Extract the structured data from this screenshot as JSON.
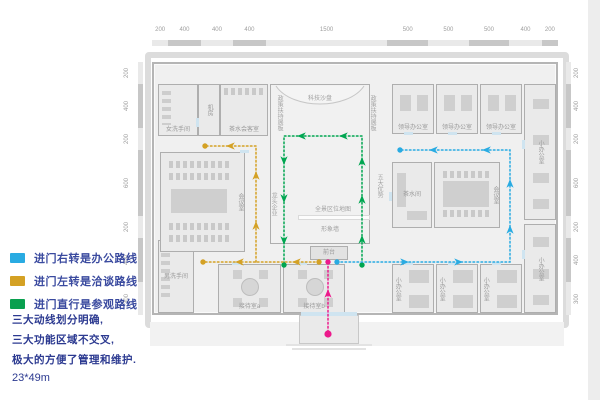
{
  "legend": {
    "items": [
      {
        "id": "office-route",
        "color": "#29abe2",
        "label": "进门右转是办公路线"
      },
      {
        "id": "negotiation-route",
        "color": "#d4a124",
        "label": "进门左转是洽谈路线"
      },
      {
        "id": "tour-route",
        "color": "#0aa04f",
        "label": "进门直行是参观路线"
      }
    ]
  },
  "notes": {
    "lines": [
      "三大动线划分明确,",
      "三大功能区域不交叉,",
      "极大的方便了管理和维护."
    ],
    "dimension": "23*49m"
  },
  "rulers": {
    "top": {
      "values": [
        200,
        400,
        400,
        400,
        1500,
        500,
        500,
        500,
        400,
        200
      ],
      "total": 5000
    },
    "left": {
      "values": [
        200,
        400,
        200,
        600,
        200,
        400,
        300
      ],
      "total": 2300
    },
    "right": {
      "values": [
        200,
        400,
        200,
        600,
        200,
        400,
        300
      ],
      "total": 2300
    }
  },
  "plan": {
    "rooms": [
      {
        "id": "women-restroom",
        "label": "女洗手间",
        "x": 158,
        "y": 84,
        "w": 40,
        "h": 52,
        "mode": "bottom",
        "shapes": [
          {
            "t": "stripes-v",
            "x": 3,
            "y": 6,
            "w": 9,
            "h": 34
          }
        ]
      },
      {
        "id": "machine-room",
        "label": "机房",
        "x": 198,
        "y": 84,
        "w": 22,
        "h": 52,
        "mode": "vcenter"
      },
      {
        "id": "tea-reception-room",
        "label": "茶水会客室",
        "x": 220,
        "y": 84,
        "w": 48,
        "h": 52,
        "mode": "bottom",
        "shapes": [
          {
            "t": "stripes-h",
            "x": 3,
            "y": 3,
            "w": 42,
            "h": 7
          }
        ]
      },
      {
        "id": "exhibition-hall",
        "label": "",
        "x": 270,
        "y": 84,
        "w": 100,
        "h": 160,
        "mode": "center",
        "fill": "#f1f1f1"
      },
      {
        "id": "leader-office-1",
        "label": "领导办公室",
        "x": 392,
        "y": 84,
        "w": 42,
        "h": 50,
        "mode": "bottom",
        "shapes": [
          {
            "t": "rect",
            "x": 7,
            "y": 10,
            "w": 11,
            "h": 16
          },
          {
            "t": "rect",
            "x": 24,
            "y": 10,
            "w": 11,
            "h": 16
          }
        ]
      },
      {
        "id": "leader-office-2",
        "label": "领导办公室",
        "x": 436,
        "y": 84,
        "w": 42,
        "h": 50,
        "mode": "bottom",
        "shapes": [
          {
            "t": "rect",
            "x": 7,
            "y": 10,
            "w": 11,
            "h": 16
          },
          {
            "t": "rect",
            "x": 24,
            "y": 10,
            "w": 11,
            "h": 16
          }
        ]
      },
      {
        "id": "leader-office-3",
        "label": "领导办公室",
        "x": 480,
        "y": 84,
        "w": 42,
        "h": 50,
        "mode": "bottom",
        "shapes": [
          {
            "t": "rect",
            "x": 7,
            "y": 10,
            "w": 11,
            "h": 16
          },
          {
            "t": "rect",
            "x": 24,
            "y": 10,
            "w": 11,
            "h": 16
          }
        ]
      },
      {
        "id": "small-office-strip-top",
        "label": "小办公室",
        "x": 524,
        "y": 84,
        "w": 32,
        "h": 136,
        "mode": "vcenter",
        "shapes": [
          {
            "t": "rect",
            "x": 8,
            "y": 14,
            "w": 16,
            "h": 10
          },
          {
            "t": "rect",
            "x": 8,
            "y": 50,
            "w": 16,
            "h": 10
          },
          {
            "t": "rect",
            "x": 8,
            "y": 88,
            "w": 16,
            "h": 10
          },
          {
            "t": "rect",
            "x": 8,
            "y": 114,
            "w": 16,
            "h": 10
          }
        ]
      },
      {
        "id": "tea-room-right",
        "label": "茶水间",
        "x": 392,
        "y": 162,
        "w": 40,
        "h": 66,
        "mode": "center",
        "shapes": [
          {
            "t": "rect",
            "x": 4,
            "y": 10,
            "w": 9,
            "h": 34
          },
          {
            "t": "rect",
            "x": 14,
            "y": 48,
            "w": 20,
            "h": 9
          }
        ]
      },
      {
        "id": "meeting-room-right",
        "label": "会议室",
        "x": 434,
        "y": 162,
        "w": 66,
        "h": 66,
        "mode": "vright",
        "shapes": [
          {
            "t": "stripes-h",
            "x": 8,
            "y": 8,
            "w": 46,
            "h": 7
          },
          {
            "t": "rect",
            "x": 8,
            "y": 18,
            "w": 46,
            "h": 26
          },
          {
            "t": "stripes-h",
            "x": 8,
            "y": 47,
            "w": 46,
            "h": 7
          }
        ]
      },
      {
        "id": "small-office-strip-bottom",
        "label": "小办公室",
        "x": 524,
        "y": 224,
        "w": 32,
        "h": 89,
        "mode": "vcenter",
        "shapes": [
          {
            "t": "rect",
            "x": 8,
            "y": 12,
            "w": 16,
            "h": 10
          },
          {
            "t": "rect",
            "x": 8,
            "y": 44,
            "w": 16,
            "h": 10
          },
          {
            "t": "rect",
            "x": 8,
            "y": 70,
            "w": 16,
            "h": 10
          }
        ]
      },
      {
        "id": "mens-restroom",
        "label": "男洗手间",
        "x": 158,
        "y": 240,
        "w": 36,
        "h": 73,
        "mode": "center",
        "shapes": [
          {
            "t": "stripes-v",
            "x": 2,
            "y": 12,
            "w": 9,
            "h": 48
          }
        ]
      },
      {
        "id": "reception-room-a",
        "label": "接待室a",
        "x": 218,
        "y": 264,
        "w": 63,
        "h": 49,
        "mode": "bottom",
        "shapes": [
          {
            "t": "circle",
            "x": 22,
            "y": 13,
            "w": 18,
            "h": 18
          },
          {
            "t": "rect",
            "x": 14,
            "y": 5,
            "w": 9,
            "h": 9
          },
          {
            "t": "rect",
            "x": 40,
            "y": 5,
            "w": 9,
            "h": 9
          },
          {
            "t": "rect",
            "x": 14,
            "y": 33,
            "w": 9,
            "h": 9
          },
          {
            "t": "rect",
            "x": 40,
            "y": 33,
            "w": 9,
            "h": 9
          }
        ]
      },
      {
        "id": "reception-room-b",
        "label": "接待室b",
        "x": 283,
        "y": 264,
        "w": 62,
        "h": 49,
        "mode": "bottom",
        "shapes": [
          {
            "t": "circle",
            "x": 22,
            "y": 13,
            "w": 18,
            "h": 18
          },
          {
            "t": "rect",
            "x": 14,
            "y": 5,
            "w": 9,
            "h": 9
          },
          {
            "t": "rect",
            "x": 40,
            "y": 5,
            "w": 9,
            "h": 9
          },
          {
            "t": "rect",
            "x": 14,
            "y": 33,
            "w": 9,
            "h": 9
          },
          {
            "t": "rect",
            "x": 40,
            "y": 33,
            "w": 9,
            "h": 9
          }
        ]
      },
      {
        "id": "small-office-1",
        "label": "小办公室",
        "x": 392,
        "y": 264,
        "w": 42,
        "h": 49,
        "mode": "vleft",
        "shapes": [
          {
            "t": "rect",
            "x": 16,
            "y": 5,
            "w": 20,
            "h": 13
          },
          {
            "t": "rect",
            "x": 16,
            "y": 30,
            "w": 20,
            "h": 13
          }
        ]
      },
      {
        "id": "small-office-2",
        "label": "小办公室",
        "x": 436,
        "y": 264,
        "w": 42,
        "h": 49,
        "mode": "vleft",
        "shapes": [
          {
            "t": "rect",
            "x": 16,
            "y": 5,
            "w": 20,
            "h": 13
          },
          {
            "t": "rect",
            "x": 16,
            "y": 30,
            "w": 20,
            "h": 13
          }
        ]
      },
      {
        "id": "small-office-3",
        "label": "小办公室",
        "x": 480,
        "y": 264,
        "w": 42,
        "h": 49,
        "mode": "vleft",
        "shapes": [
          {
            "t": "rect",
            "x": 16,
            "y": 5,
            "w": 20,
            "h": 13
          },
          {
            "t": "rect",
            "x": 16,
            "y": 30,
            "w": 20,
            "h": 13
          }
        ]
      },
      {
        "id": "meeting-room-left",
        "label": "会议室",
        "x": 160,
        "y": 152,
        "w": 85,
        "h": 100,
        "mode": "vright",
        "shapes": [
          {
            "t": "stripes-h",
            "x": 8,
            "y": 8,
            "w": 60,
            "h": 7
          },
          {
            "t": "stripes-h",
            "x": 8,
            "y": 20,
            "w": 60,
            "h": 7
          },
          {
            "t": "rect",
            "x": 10,
            "y": 36,
            "w": 56,
            "h": 24
          },
          {
            "t": "stripes-h",
            "x": 8,
            "y": 70,
            "w": 60,
            "h": 7
          },
          {
            "t": "stripes-h",
            "x": 8,
            "y": 82,
            "w": 60,
            "h": 7
          }
        ]
      },
      {
        "id": "front-desk",
        "label": "前台",
        "x": 310,
        "y": 246,
        "w": 38,
        "h": 14,
        "mode": "center",
        "fill": "#e2e2e2"
      }
    ],
    "texts": [
      {
        "id": "tech-sandtable-label",
        "label": "科技沙盘",
        "x": 320,
        "y": 99
      },
      {
        "id": "policy-board-left",
        "label": "政策扶持展板",
        "x": 279,
        "y": 113,
        "v": 1
      },
      {
        "id": "policy-board-right",
        "label": "政策扶持展板",
        "x": 372,
        "y": 113,
        "v": 1
      },
      {
        "id": "five-advantages-board",
        "label": "五大优势",
        "x": 379,
        "y": 186,
        "v": 1
      },
      {
        "id": "leading-enterprise-board",
        "label": "龙头企业",
        "x": 273,
        "y": 204,
        "v": 1
      },
      {
        "id": "panorama-map-wall",
        "label": "全景区位地图",
        "x": 333,
        "y": 210
      },
      {
        "id": "image-wall",
        "label": "形象墙",
        "x": 330,
        "y": 230
      }
    ],
    "doors": [
      [
        404,
        132,
        9,
        3
      ],
      [
        448,
        132,
        9,
        3
      ],
      [
        492,
        132,
        9,
        3
      ],
      [
        404,
        262,
        9,
        3
      ],
      [
        448,
        262,
        9,
        3
      ],
      [
        492,
        262,
        9,
        3
      ],
      [
        232,
        262,
        9,
        3
      ],
      [
        298,
        262,
        9,
        3
      ],
      [
        522,
        140,
        3,
        9
      ],
      [
        522,
        250,
        3,
        9
      ],
      [
        389,
        192,
        3,
        9
      ],
      [
        240,
        150,
        9,
        3
      ],
      [
        196,
        118,
        3,
        9
      ],
      [
        301,
        312,
        56,
        4
      ]
    ],
    "decor": [
      {
        "x": 298,
        "y": 215,
        "w": 72,
        "h": 5
      }
    ],
    "steps": [
      [
        286,
        344,
        86,
        2
      ],
      [
        292,
        348,
        74,
        2
      ]
    ],
    "hall_curve": "M276,86 C292,110 348,110 364,86",
    "routes": [
      {
        "id": "tour-route-green",
        "color": "#00a651",
        "lines": [
          [
            [
              362,
              264
            ],
            [
              362,
              136
            ],
            [
              284,
              136
            ],
            [
              284,
              264
            ]
          ]
        ],
        "dots": [
          [
            362,
            265
          ],
          [
            284,
            265
          ]
        ],
        "arrows": [
          [
            362,
            240,
            0
          ],
          [
            362,
            200,
            0
          ],
          [
            362,
            162,
            0
          ],
          [
            344,
            136,
            270
          ],
          [
            302,
            136,
            270
          ],
          [
            284,
            160,
            180
          ],
          [
            284,
            198,
            180
          ],
          [
            284,
            240,
            180
          ]
        ]
      },
      {
        "id": "negotiation-route-gold",
        "color": "#d4a124",
        "lines": [
          [
            [
              319,
              262
            ],
            [
              203,
              262
            ]
          ],
          [
            [
              256,
              262
            ],
            [
              256,
              146
            ],
            [
              205,
              146
            ]
          ]
        ],
        "dots": [
          [
            319,
            262
          ],
          [
            203,
            262
          ],
          [
            205,
            146
          ]
        ],
        "arrows": [
          [
            297,
            262,
            270
          ],
          [
            240,
            262,
            270
          ],
          [
            256,
            226,
            0
          ],
          [
            256,
            176,
            0
          ],
          [
            231,
            146,
            270
          ]
        ]
      },
      {
        "id": "office-route-blue",
        "color": "#29abe2",
        "lines": [
          [
            [
              337,
              262
            ],
            [
              510,
              262
            ],
            [
              510,
              150
            ],
            [
              401,
              150
            ]
          ]
        ],
        "dots": [
          [
            337,
            262
          ],
          [
            400,
            150
          ]
        ],
        "arrows": [
          [
            404,
            262,
            90
          ],
          [
            458,
            262,
            90
          ],
          [
            510,
            230,
            0
          ],
          [
            510,
            184,
            0
          ],
          [
            487,
            150,
            270
          ],
          [
            434,
            150,
            270
          ]
        ]
      },
      {
        "id": "entrance-route-magenta",
        "color": "#ec1a8c",
        "lines": [
          [
            [
              328,
              332
            ],
            [
              328,
              264
            ]
          ]
        ],
        "dots": [
          [
            328,
            334,
            3.6
          ],
          [
            328,
            262,
            2.7
          ]
        ],
        "arrows": [
          [
            328,
            294,
            0
          ]
        ]
      }
    ]
  }
}
